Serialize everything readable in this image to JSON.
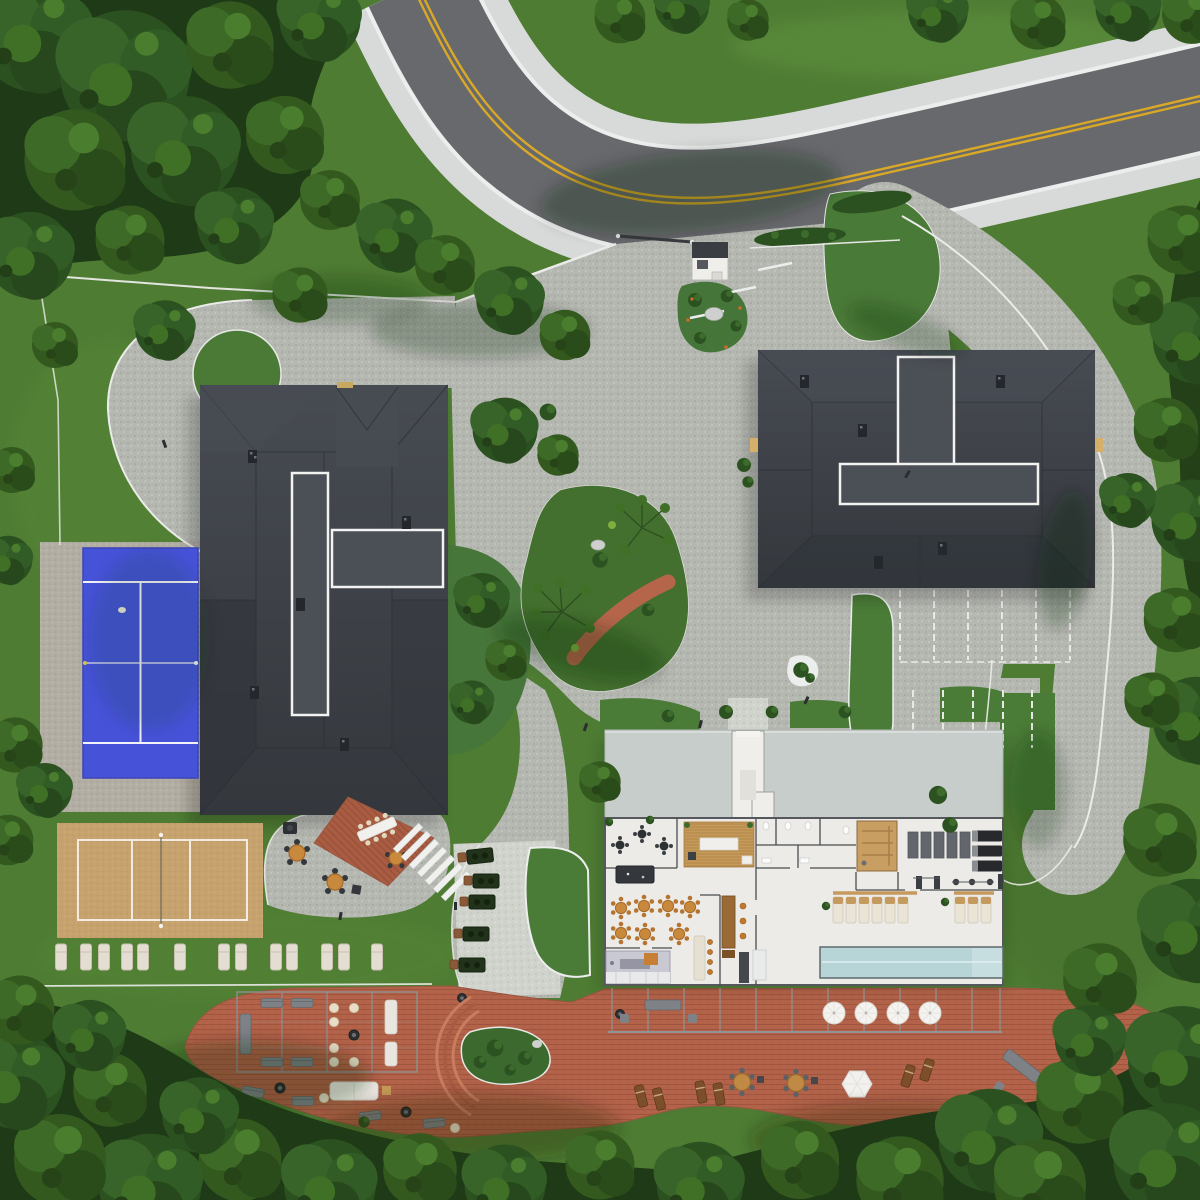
{
  "scene": {
    "title": "aerial-site-plan-render",
    "view": "top-down architectural rendering",
    "environment": {
      "ground": "lawn",
      "perimeter": "dense forest",
      "season": "summer"
    },
    "road": {
      "type": "two-lane asphalt road",
      "marking": "double yellow centerline",
      "edge": "white edge lines with concrete sidewalks both sides"
    },
    "entrance": {
      "gate": "sliding gate at driveway mouth",
      "guard_house": "small white gatehouse with dark flat roof",
      "hedge": "trimmed hedge east of gate",
      "landscape_island": "shrub island with boulder and orange flowers"
    },
    "buildings": [
      {
        "id": "west-building",
        "roof": "charcoal hip roof",
        "flat_roof_sections": 2,
        "chimneys": 5
      },
      {
        "id": "east-building",
        "roof": "charcoal hip roof",
        "flat_roof_sections": 2,
        "chimneys": 5
      },
      {
        "id": "clubhouse",
        "roof": "pale flat roof with entry vestibule",
        "rooms": [
          "cafe lounge",
          "billiards",
          "reception",
          "dining (7 round tables)",
          "kitchen",
          "bar",
          "restrooms",
          "sauna",
          "gym",
          "spa lounger row",
          "indoor lap pool"
        ]
      }
    ],
    "amenities": {
      "tennis_court": "blue hard court with white lines",
      "volleyball_court": "sand court with white lines and center net",
      "lounge_chairs_on_lawn": 13,
      "bbq_stations": 5,
      "parking_stalls_row1": 5,
      "parking_stalls_row2": 4,
      "patio_round_tables": 3,
      "deck_round_tables": 2,
      "pool_deck_umbrellas": 4,
      "hex_umbrella": 1,
      "pergolas": 2,
      "fire_pits": 3,
      "central_island": "planted island with ornamental trees and curved terracotta path",
      "driveway_loop": "circular turnaround with round lawn island",
      "main_deck": "large curved terracotta wood deck"
    },
    "colors": {
      "grass": "#4e7c33",
      "forest": "#24421a",
      "asphalt": "#67696c",
      "yellow_line": "#d9a827",
      "sidewalk": "#d8dad9",
      "pavers": "#b5b7b1",
      "walkway": "#cfd1cb",
      "roof_dark": "#3b3f45",
      "roof_flat": "#4b4f56",
      "clubhouse_roof": "#c7cdca",
      "clubhouse_floor": "#edebe7",
      "pool_water": "#b7d4d6",
      "deck": "#b26349",
      "tennis_court": "#4653d8",
      "sand": "#c6a26e",
      "lounge_chair": "#e4ded2",
      "table_wood": "#c9893d",
      "curb": "#ebebe9"
    }
  }
}
